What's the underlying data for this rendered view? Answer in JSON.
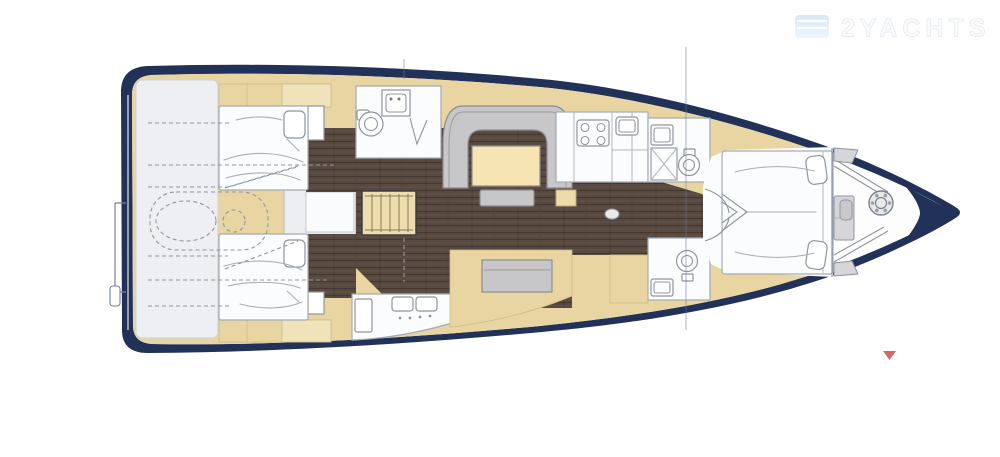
{
  "page": {
    "background": "#ffffff",
    "description": "Sailing yacht interior deck plan, top view, bow to the right"
  },
  "watermark": {
    "brand": "2YACHTS"
  },
  "colors": {
    "hull": "#223158",
    "deck": "#e8d5a2",
    "deck_light": "#f0e3ba",
    "garage": "#edeff3",
    "floor": "#57493f",
    "furniture": "#c7c7ca",
    "furniture_edge": "#8d8d90",
    "room": "#fbfcfd",
    "room_edge": "#a5abb4",
    "fixture_edge": "#8f959e",
    "bow_gray": "#d6d6da",
    "stairs": "#eeddae",
    "stairs_edge": "#3f3f43",
    "table": "#f6e5b2",
    "dash": "#8f97a3",
    "marker": "#d4686a",
    "watermark_edge": "#e4e9ee",
    "wm_flag1": "#d8e8f6",
    "wm_flag2": "#eef6fc",
    "mast_line": "#6d7890"
  },
  "features": [
    "swim-platform",
    "tender-garage",
    "aft-cabin-starboard",
    "aft-cabin-port",
    "aft-head",
    "companionway-stairs",
    "salon-sofa",
    "salon-table",
    "galley",
    "port-settee",
    "forward-head-starboard",
    "forward-head-port",
    "owners-cabin",
    "anchor-windlass",
    "bow-tip",
    "mast-line",
    "red-marker"
  ]
}
